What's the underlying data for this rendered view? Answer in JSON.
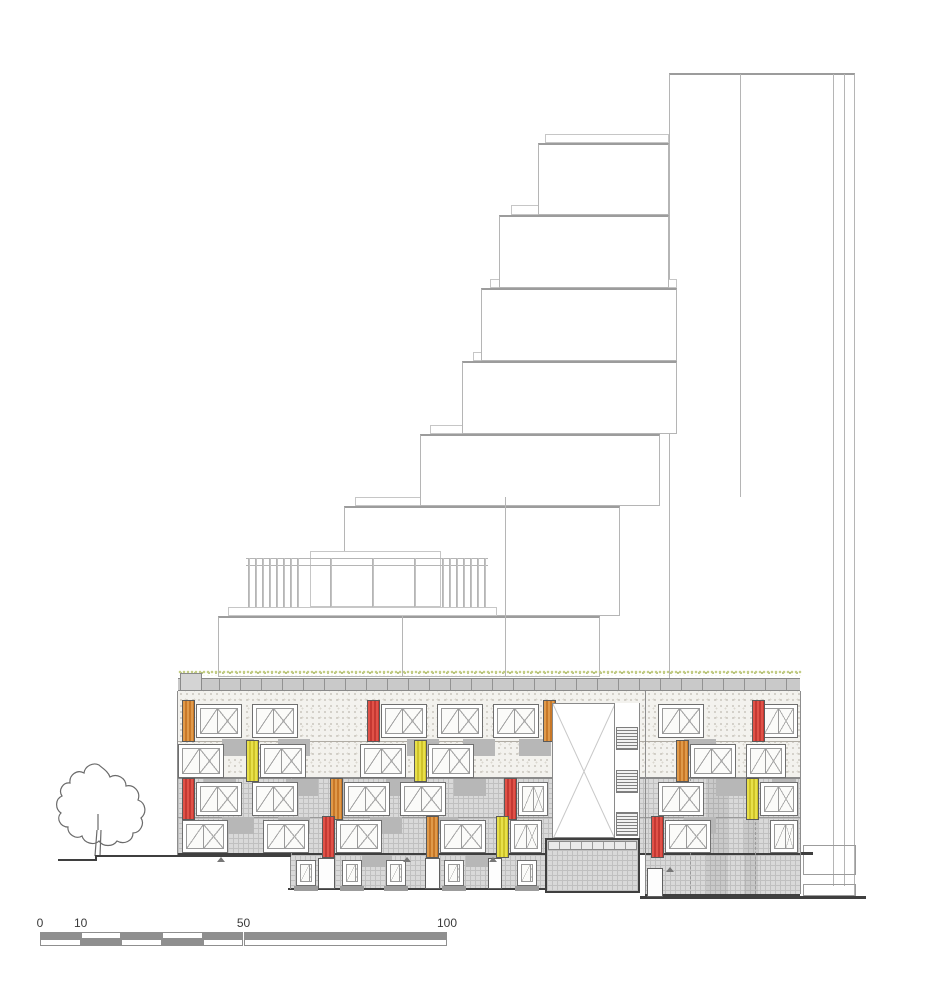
{
  "drawing": {
    "type": "architectural-elevation",
    "description": "stepped tower elevation with colored facade panels, tree and scale bar"
  },
  "palette": {
    "accent_orange": [
      "#e09a4a",
      "#c87828"
    ],
    "accent_red": [
      "#e05248",
      "#c43832"
    ],
    "accent_yellow": [
      "#e8e04a",
      "#cfc32a"
    ],
    "spandrel_gray": "#b7b7b7",
    "outline_light": "#b5b5b5",
    "outline_mid": "#9c9c9c",
    "line_dark": "#3f3f3f",
    "green_roof": "#c3cd85"
  },
  "outline": {
    "tower": {
      "x": 669,
      "y": 73,
      "w": 186,
      "h": 824,
      "verticals": [
        [
          740,
          74,
          497
        ],
        [
          833,
          74,
          886
        ],
        [
          844,
          74,
          886
        ]
      ],
      "base_boxes": [
        [
          803,
          845,
          53,
          30
        ],
        [
          803,
          884,
          53,
          12
        ]
      ],
      "dark_segments": [
        [
          779,
          852,
          34,
          3
        ],
        [
          640,
          896,
          226,
          3
        ]
      ]
    },
    "boxes": [
      [
        538,
        143,
        131,
        72
      ],
      [
        499,
        215,
        170,
        73
      ],
      [
        481,
        288,
        196,
        73
      ],
      [
        462,
        361,
        215,
        73
      ],
      [
        420,
        434,
        240,
        72
      ],
      [
        344,
        506,
        276,
        110
      ],
      [
        218,
        616,
        382,
        61
      ]
    ],
    "bands": [
      [
        545,
        134,
        124,
        9
      ],
      [
        511,
        205,
        158,
        10
      ],
      [
        490,
        279,
        187,
        9
      ],
      [
        473,
        352,
        204,
        9
      ],
      [
        430,
        425,
        239,
        9
      ],
      [
        355,
        497,
        265,
        9
      ]
    ],
    "verticals": [
      [
        402,
        607,
        677
      ],
      [
        505,
        497,
        677
      ]
    ],
    "terrace": {
      "slab": [
        228,
        607,
        269,
        9
      ],
      "rails": [
        [
          246,
          558,
          242
        ],
        [
          246,
          565,
          242
        ]
      ],
      "post_top": 558,
      "post_bottom": 607,
      "posts": [
        248,
        255,
        262,
        269,
        276,
        283,
        290,
        297,
        330,
        372,
        414,
        442,
        449,
        456,
        463,
        470,
        477,
        484
      ],
      "box": [
        310,
        551,
        131,
        56
      ]
    }
  },
  "building": {
    "green_roof": [
      178,
      670,
      624,
      6
    ],
    "parapet": [
      178,
      678,
      622,
      13
    ],
    "parapet_block": [
      180,
      673,
      22,
      18
    ],
    "stipple_zone": [
      178,
      691,
      622,
      87
    ],
    "grid_zones": [
      [
        178,
        778,
        622,
        77
      ],
      [
        290,
        855,
        255,
        35
      ],
      [
        645,
        855,
        155,
        41
      ]
    ],
    "floor_lines": [
      [
        178,
        741,
        622,
        1,
        "#b0aca4"
      ],
      [
        178,
        777,
        622,
        2,
        "#8a8a8a"
      ],
      [
        178,
        817,
        622,
        1,
        "#9a9a9a"
      ],
      [
        178,
        853,
        622,
        2,
        "#3f3f3f"
      ],
      [
        288,
        888,
        259,
        2,
        "#3f3f3f"
      ],
      [
        645,
        894,
        155,
        2,
        "#3f3f3f"
      ]
    ],
    "verticals": [
      [
        177,
        691,
        855
      ],
      [
        645,
        691,
        894
      ],
      [
        800,
        691,
        894
      ],
      [
        290,
        855,
        889
      ]
    ],
    "dashed_verticals": [
      [
        291,
        778,
        855
      ],
      [
        690,
        778,
        894
      ],
      [
        755,
        778,
        894
      ]
    ],
    "shade_bands": [
      [
        706,
        778,
        22,
        116
      ],
      [
        744,
        820,
        14,
        74
      ]
    ],
    "void": {
      "rect": [
        552,
        703,
        88,
        135
      ],
      "strip_x": 614,
      "strip_w": 26,
      "louvers": [
        [
          616,
          727,
          22,
          23
        ],
        [
          616,
          770,
          22,
          23
        ],
        [
          616,
          812,
          22,
          24
        ]
      ]
    },
    "entry_box": [
      545,
      838,
      95,
      55
    ],
    "entry_band": [
      548,
      841,
      89,
      9
    ],
    "right_door": [
      647,
      868,
      16,
      29
    ],
    "rows": [
      {
        "y": 704,
        "h": 34,
        "windows": [
          [
            196,
            46
          ],
          [
            252,
            46
          ],
          [
            381,
            46
          ],
          [
            437,
            46
          ],
          [
            493,
            46
          ],
          [
            658,
            46
          ],
          [
            760,
            38
          ]
        ],
        "panels": [
          [
            182,
            "orange"
          ],
          [
            367,
            "red"
          ],
          [
            543,
            "orange"
          ],
          [
            752,
            "red"
          ]
        ]
      },
      {
        "y": 744,
        "h": 34,
        "windows": [
          [
            178,
            46
          ],
          [
            260,
            46
          ],
          [
            360,
            46
          ],
          [
            428,
            46
          ],
          [
            690,
            46
          ],
          [
            746,
            40
          ]
        ],
        "panels": [
          [
            246,
            "yellow"
          ],
          [
            414,
            "yellow"
          ],
          [
            676,
            "orange"
          ]
        ]
      },
      {
        "y": 782,
        "h": 34,
        "windows": [
          [
            196,
            46
          ],
          [
            252,
            46
          ],
          [
            344,
            46
          ],
          [
            400,
            46
          ],
          [
            518,
            30
          ],
          [
            658,
            46
          ],
          [
            760,
            38
          ]
        ],
        "panels": [
          [
            182,
            "red"
          ],
          [
            330,
            "orange"
          ],
          [
            504,
            "red"
          ],
          [
            746,
            "yellow"
          ]
        ]
      },
      {
        "y": 820,
        "h": 33,
        "windows": [
          [
            182,
            46
          ],
          [
            263,
            46
          ],
          [
            336,
            46
          ],
          [
            440,
            46
          ],
          [
            510,
            32
          ],
          [
            665,
            46
          ],
          [
            770,
            28
          ]
        ],
        "panels": [
          [
            322,
            "red"
          ],
          [
            426,
            "orange"
          ],
          [
            496,
            "yellow"
          ],
          [
            651,
            "red"
          ]
        ]
      }
    ],
    "lower_row": {
      "y": 860,
      "h": 26,
      "win_w": 20,
      "windows": [
        296,
        342,
        386,
        444,
        517
      ],
      "doors": [
        [
          318,
          858,
          17,
          31
        ],
        [
          425,
          858,
          15,
          31
        ],
        [
          488,
          858,
          14,
          31
        ]
      ]
    },
    "spandrels": [
      [
        222,
        739,
        32,
        17
      ],
      [
        278,
        739,
        32,
        17
      ],
      [
        407,
        739,
        32,
        17
      ],
      [
        463,
        739,
        32,
        17
      ],
      [
        519,
        739,
        32,
        17
      ],
      [
        684,
        739,
        32,
        17
      ],
      [
        204,
        779,
        32,
        17
      ],
      [
        286,
        779,
        32,
        17
      ],
      [
        386,
        779,
        32,
        17
      ],
      [
        454,
        779,
        32,
        17
      ],
      [
        716,
        779,
        32,
        17
      ],
      [
        772,
        779,
        24,
        17
      ],
      [
        222,
        817,
        32,
        17
      ],
      [
        278,
        817,
        32,
        17
      ],
      [
        370,
        817,
        32,
        17
      ],
      [
        426,
        817,
        32,
        17
      ],
      [
        684,
        817,
        32,
        17
      ],
      [
        362,
        855,
        30,
        12
      ],
      [
        466,
        855,
        30,
        12
      ]
    ],
    "sills": [
      [
        294,
        886,
        24,
        5
      ],
      [
        340,
        886,
        24,
        5
      ],
      [
        384,
        886,
        24,
        5
      ],
      [
        442,
        886,
        24,
        5
      ],
      [
        515,
        886,
        24,
        5
      ]
    ],
    "markers": [
      [
        217,
        857
      ],
      [
        403,
        857
      ],
      [
        489,
        857
      ],
      [
        666,
        867
      ]
    ]
  },
  "tree": {
    "canopy_path": "M99,765 c-6,-3 -14,1 -15,8 c-7,-4 -15,2 -14,10 c-7,-1 -12,7 -8,13 c-7,3 -7,13 -1,17 c-5,5 -1,14 7,14 c-1,7 8,13 14,9 c2,7 12,10 17,5 c4,6 14,6 18,0 c7,4 16,0 16,-8 c7,0 12,-9 8,-15 c6,-5 5,-15 -3,-18 c3,-8 -4,-16 -12,-14 c0,-8 -9,-13 -16,-9 c-2,-6 -8,-9 -11,-12 z",
    "trunk_path": "M97,830 L95,856 M101,830 L100,856 M98,814 L98,830",
    "ground_path": "M58,860 L96,860 L96,856 L291,856"
  },
  "scale_bar": {
    "x": 40,
    "y": 932,
    "label_y": 916,
    "row_h": 7,
    "px_per_unit": 4.07,
    "labels": [
      {
        "text": "0",
        "u": 0
      },
      {
        "text": "10",
        "u": 10
      },
      {
        "text": "50",
        "u": 50
      },
      {
        "text": "100",
        "u": 100
      }
    ],
    "top_segments": [
      [
        0,
        10,
        true
      ],
      [
        10,
        20,
        false
      ],
      [
        20,
        30,
        true
      ],
      [
        30,
        40,
        false
      ],
      [
        40,
        50,
        true
      ],
      [
        50,
        100,
        true
      ]
    ],
    "bottom_segments": [
      [
        0,
        10,
        false
      ],
      [
        10,
        20,
        true
      ],
      [
        20,
        30,
        false
      ],
      [
        30,
        40,
        true
      ],
      [
        40,
        50,
        false
      ],
      [
        50,
        100,
        false
      ]
    ],
    "fill_gray": "#8f8f8f"
  }
}
